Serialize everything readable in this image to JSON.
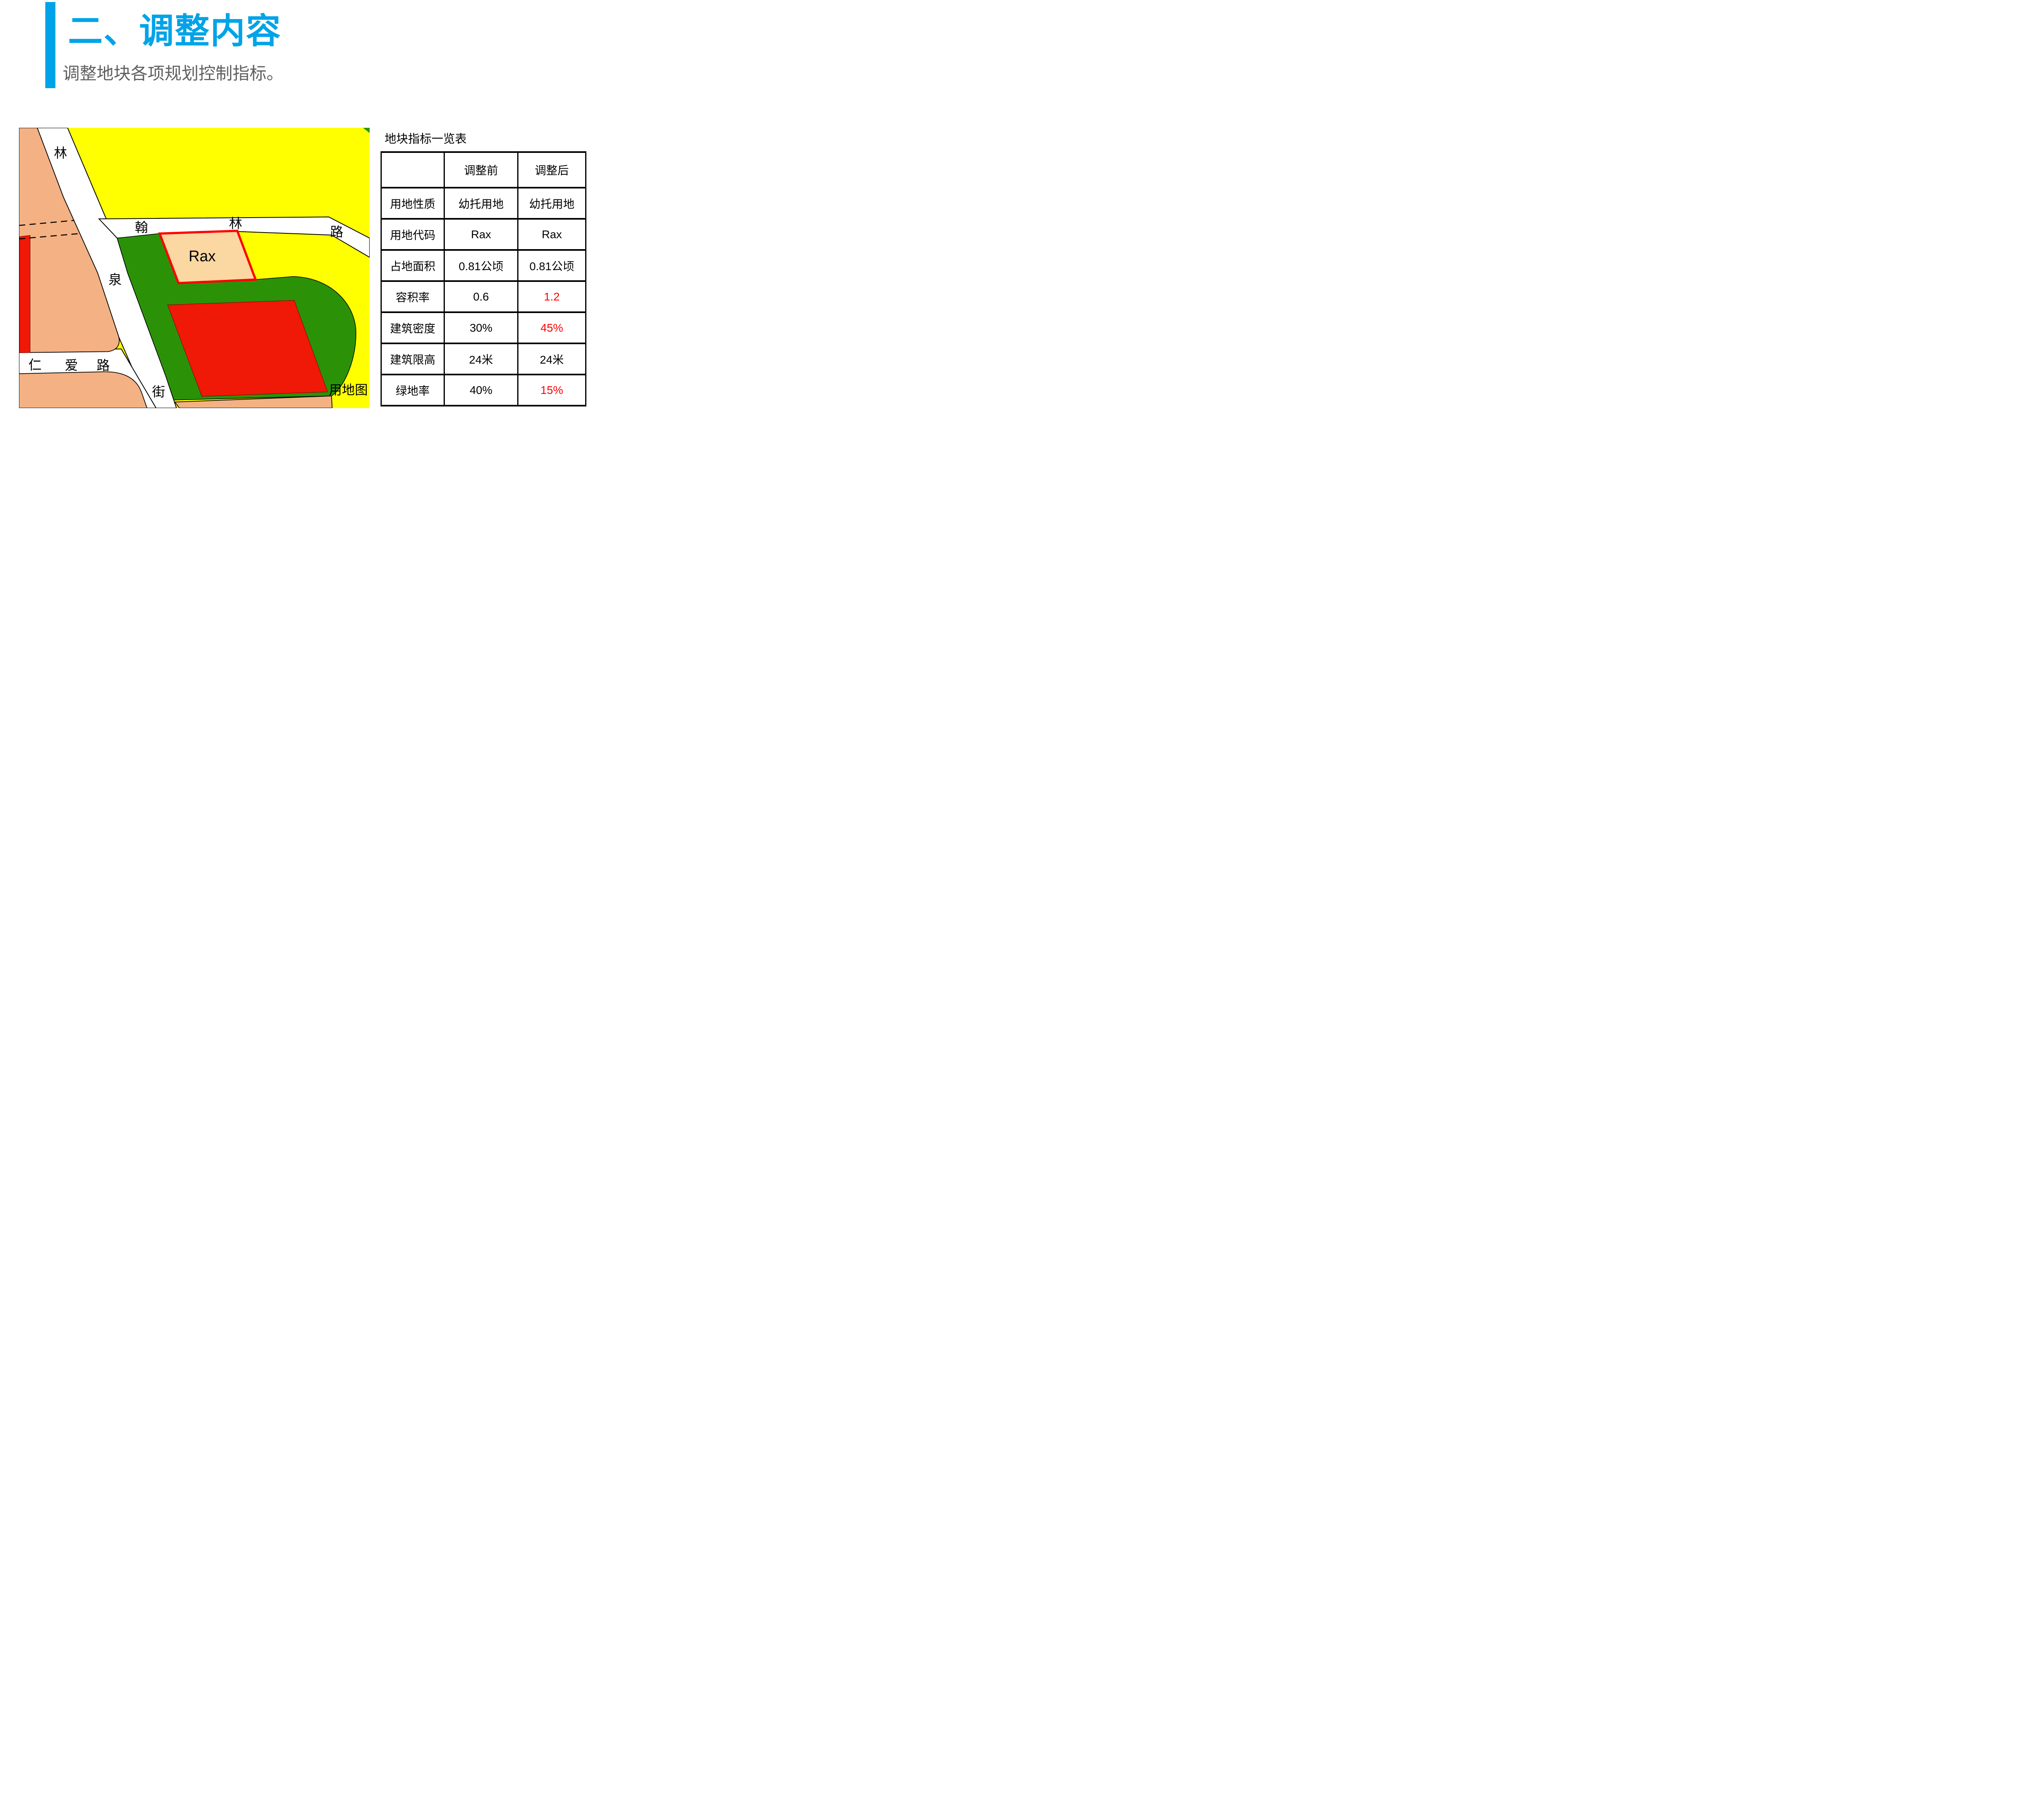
{
  "slide": {
    "title": "二、调整内容",
    "subtitle": "调整地块各项规划控制指标。"
  },
  "colors": {
    "accent_blue": "#00A3E8",
    "subtitle_gray": "#606060",
    "map_yellow": "#FFFF00",
    "map_orange": "#F4B183",
    "map_green": "#2B9208",
    "map_red": "#F01806",
    "parcel_tan": "#FBD7A2",
    "table_changed_red": "#FF0000",
    "text_black": "#000000"
  },
  "map": {
    "caption": "用地图",
    "parcel_label": "Rax",
    "labels": {
      "linquan_street": [
        "林",
        "泉",
        "街"
      ],
      "hanlin_road": [
        "翰",
        "林",
        "路"
      ],
      "renai_road": [
        "仁",
        "爱",
        "路"
      ]
    }
  },
  "table": {
    "title": "地块指标一览表",
    "columns": [
      "",
      "调整前",
      "调整后"
    ],
    "rows": [
      {
        "label": "用地性质",
        "before": "幼托用地",
        "after": "幼托用地",
        "after_changed": false
      },
      {
        "label": "用地代码",
        "before": "Rax",
        "after": "Rax",
        "after_changed": false
      },
      {
        "label": "占地面积",
        "before": "0.81公顷",
        "after": "0.81公顷",
        "after_changed": false
      },
      {
        "label": "容积率",
        "before": "0.6",
        "after": "1.2",
        "after_changed": true
      },
      {
        "label": "建筑密度",
        "before": "30%",
        "after": "45%",
        "after_changed": true
      },
      {
        "label": "建筑限高",
        "before": "24米",
        "after": "24米",
        "after_changed": false
      },
      {
        "label": "绿地率",
        "before": "40%",
        "after": "15%",
        "after_changed": true
      }
    ]
  }
}
